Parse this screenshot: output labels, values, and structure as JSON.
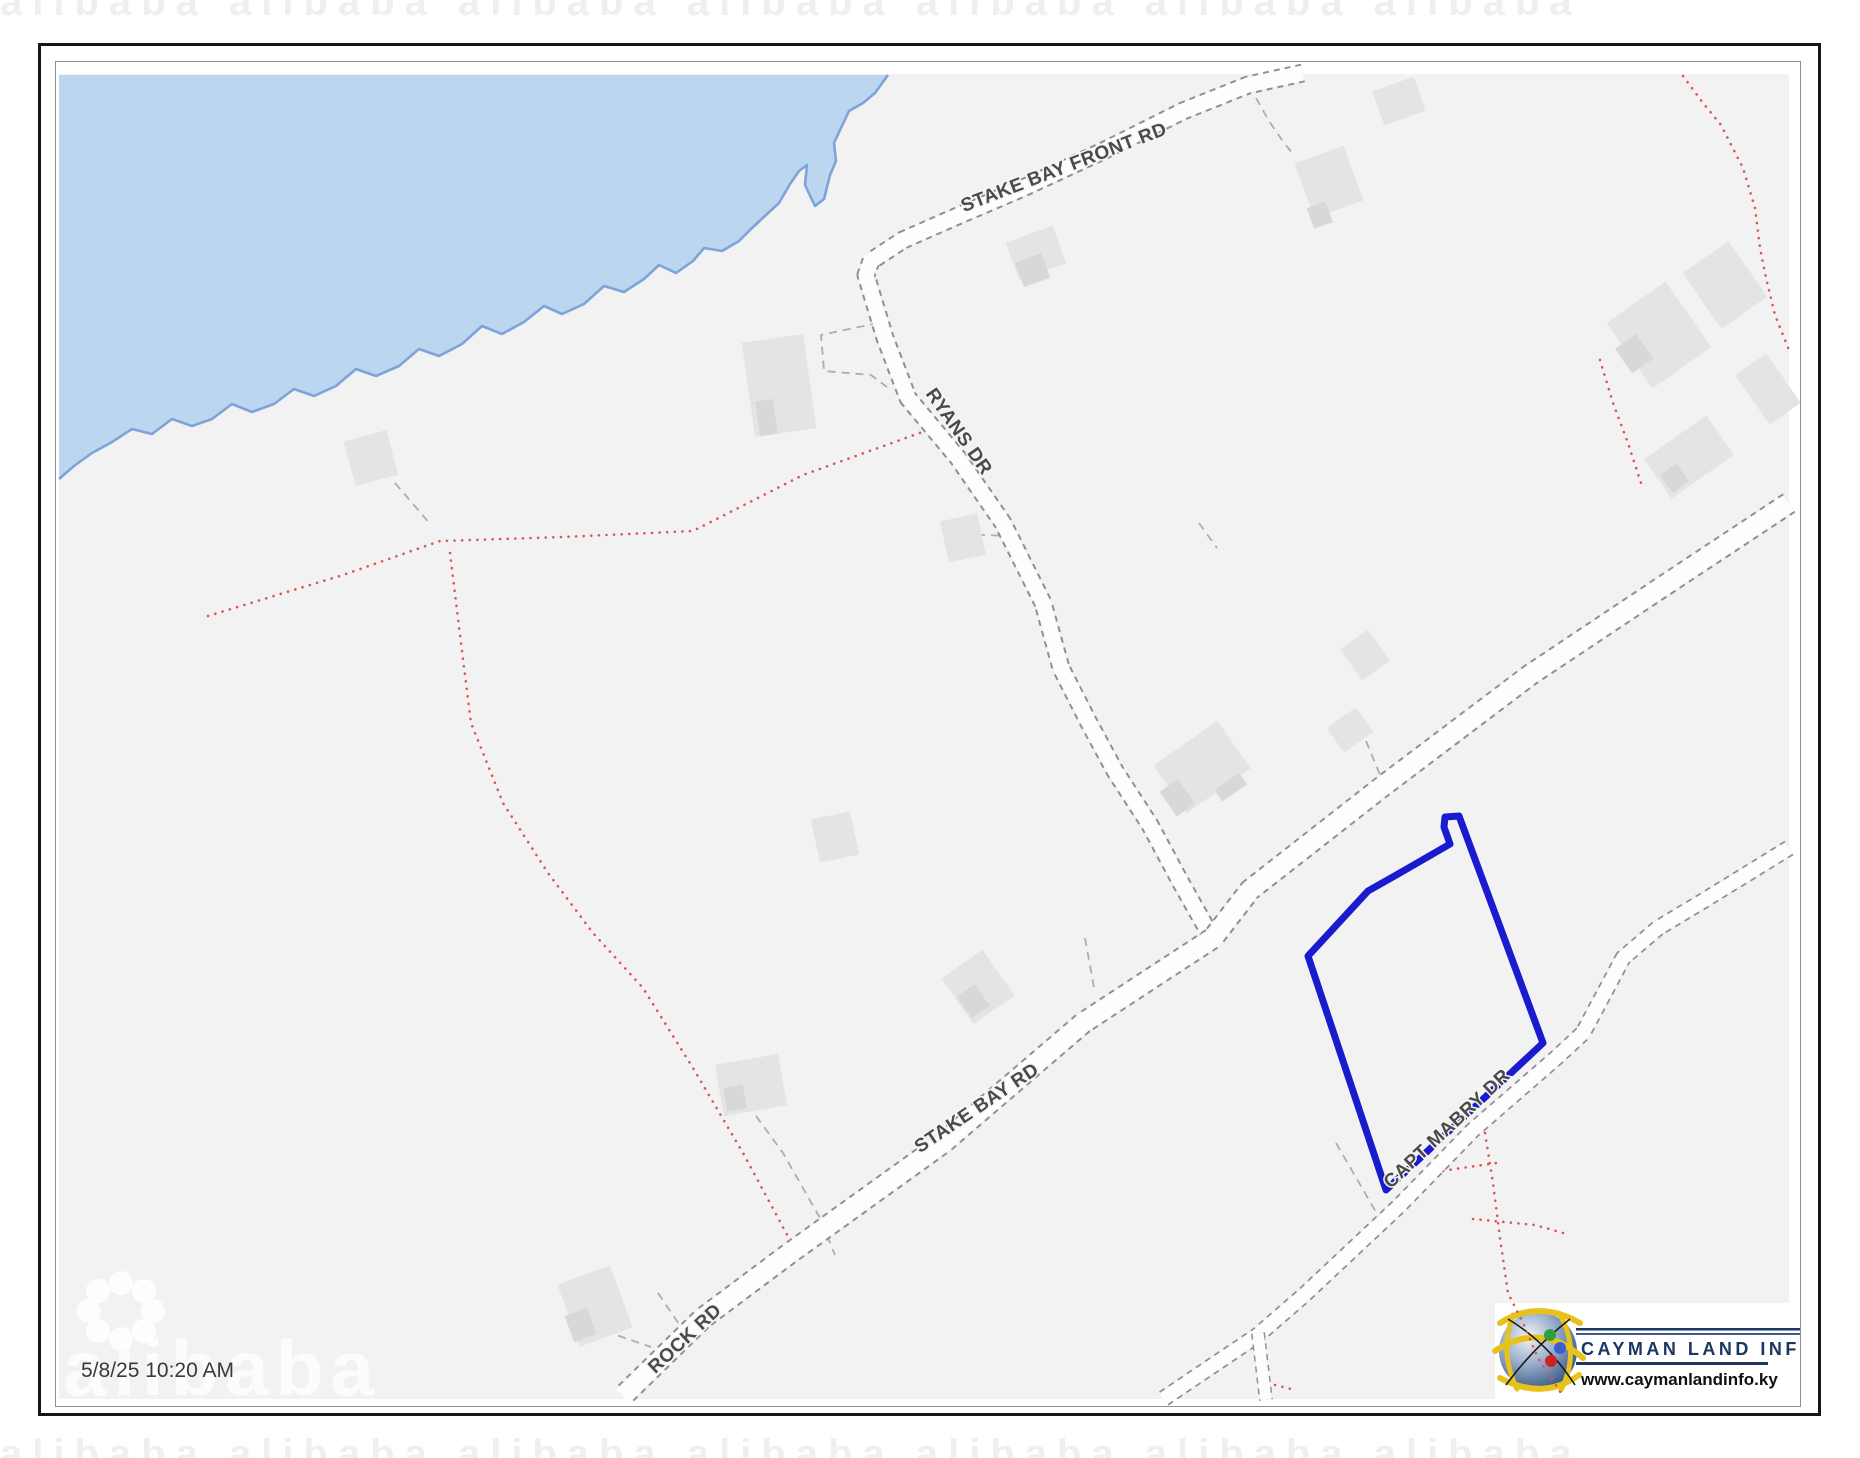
{
  "map": {
    "timestamp": "5/8/25 10:20 AM",
    "watermark_text": "alibaba",
    "watermark_row": "alibaba      alibaba      alibaba      alibaba      alibaba      alibaba      alibaba",
    "road_labels": {
      "stake_bay_front": "STAKE BAY FRONT RD",
      "ryans": "RYANS DR",
      "stake_bay": "STAKE BAY RD",
      "rock": "ROCK RD",
      "capt_mabry": "CAPT MABRY DR"
    },
    "parcel": {
      "points": "1442,814 1456,813 1540,1040 1383,1187 1305,953 1365,888 1402,867 1447,841 1441,824",
      "color": "#1a1acf"
    },
    "colors": {
      "water": "#bdd6f0",
      "coastline": "#7da3d8",
      "land": "#f2f2f3",
      "road_fill": "#fdfdfd",
      "road_casing": "#909090",
      "building": "#e4e4e7",
      "building_dark": "#d8d8db",
      "boundary_red": "#dd5555",
      "dashed_gray": "#adadad",
      "road_label_color": "#4a4a4a"
    }
  },
  "logo": {
    "name": "CAYMAN LAND INFO",
    "website": "www.caymanlandinfo.ky",
    "navy": "#1c3662"
  }
}
